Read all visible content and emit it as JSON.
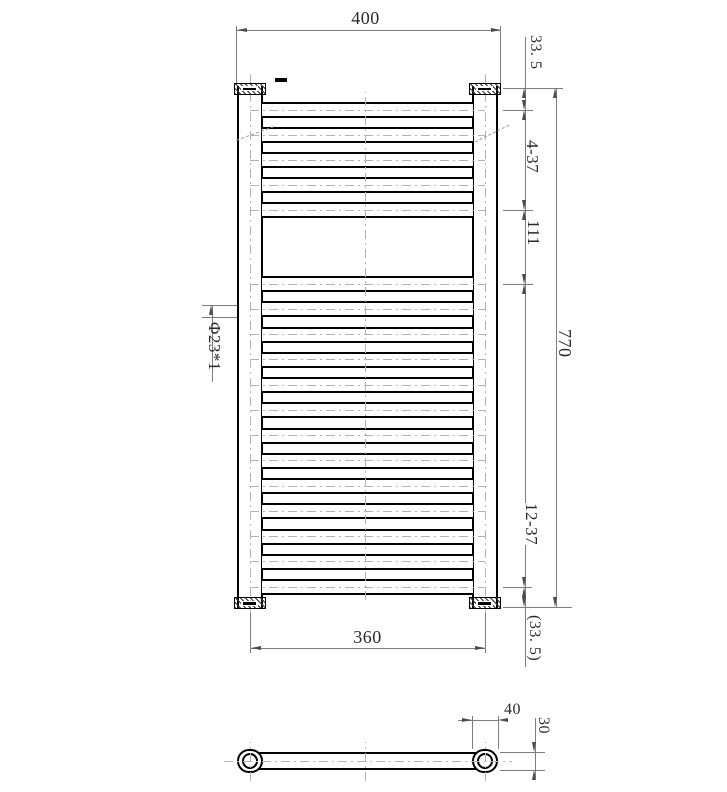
{
  "drawing": {
    "type": "technical-drawing",
    "subject": "heated towel rail radiator, front view and top view",
    "front_view": {
      "rung_groups": [
        {
          "count": 5,
          "pitch_label": "4-37"
        },
        {
          "count": 13,
          "pitch_label": "12-37"
        }
      ],
      "dimensions": {
        "overall_width": "400",
        "top_offset": "33. 5",
        "top_group_pitch": "4-37",
        "middle_gap": "111",
        "overall_height": "770",
        "bottom_group_pitch": "12-37",
        "bottom_offset": "(33. 5)",
        "bracket_centers": "360",
        "rung_tube_spec": "Φ23*1"
      }
    },
    "top_view": {
      "dimensions": {
        "end_cap_width": "40",
        "depth": "30"
      }
    }
  }
}
